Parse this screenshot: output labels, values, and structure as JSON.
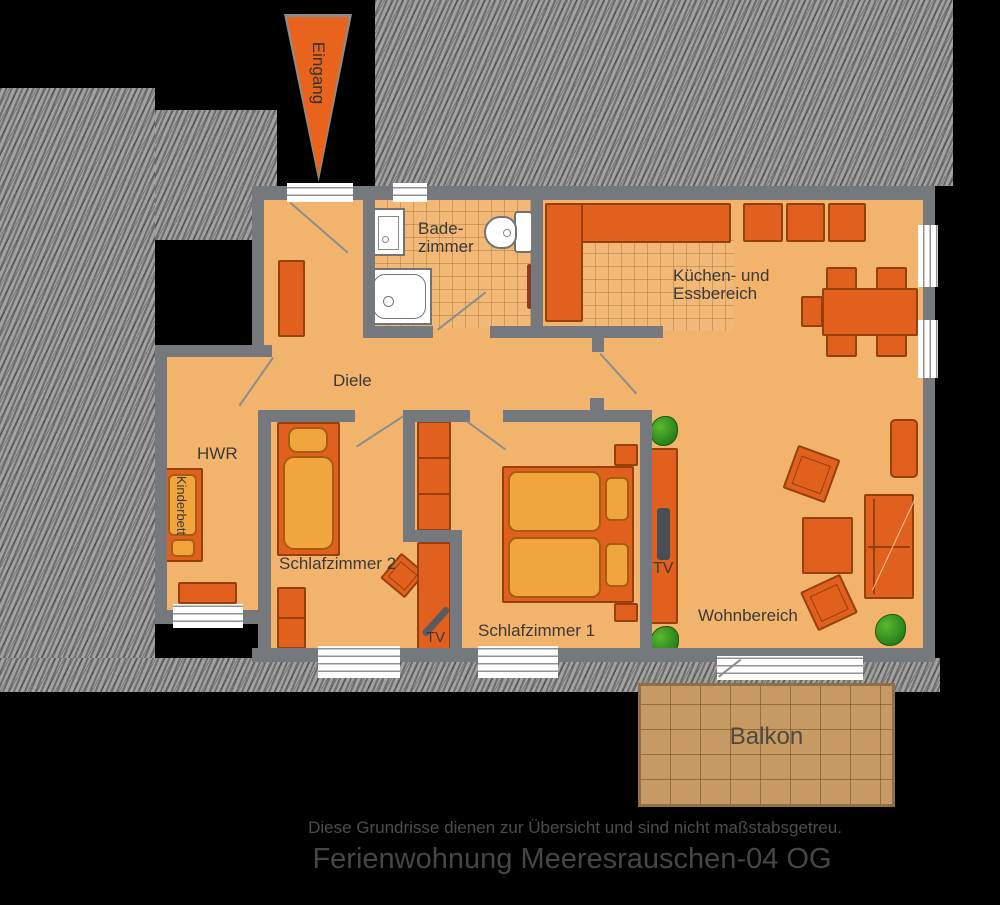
{
  "entrance": {
    "label": "Eingang"
  },
  "rooms": {
    "bathroom": {
      "label_line1": "Bade-",
      "label_line2": "zimmer"
    },
    "kitchen": {
      "label_line1": "Küchen- und",
      "label_line2": "Essbereich"
    },
    "hall": {
      "label": "Diele"
    },
    "utility": {
      "label": "HWR"
    },
    "crib": {
      "label": "Kinderbett"
    },
    "bedroom2": {
      "label": "Schlafzimmer 2",
      "tv_label": "TV"
    },
    "bedroom1": {
      "label": "Schlafzimmer 1"
    },
    "living": {
      "label": "Wohnbereich",
      "tv_label": "TV"
    },
    "balcony": {
      "label": "Balkon"
    }
  },
  "footer": {
    "disclaimer": "Diese Grundrisse dienen zur Übersicht und sind nicht maßstabsgetreu.",
    "title": "Ferienwohnung Meeresrauschen-04 OG"
  },
  "colors": {
    "floor": "#f2b46c",
    "tile_floor": "#f1b877",
    "wall": "#75797d",
    "furniture": "#e2601d",
    "furniture_light": "#f0a63c",
    "accent_arrow": "#e8631c",
    "balcony": "#c89a63",
    "plant": "#2e8b1e",
    "outside_hatch": "#9c9c9c",
    "background": "#000000",
    "label_text": "#3a3a3a",
    "footer_text": "#4d4d4d"
  }
}
